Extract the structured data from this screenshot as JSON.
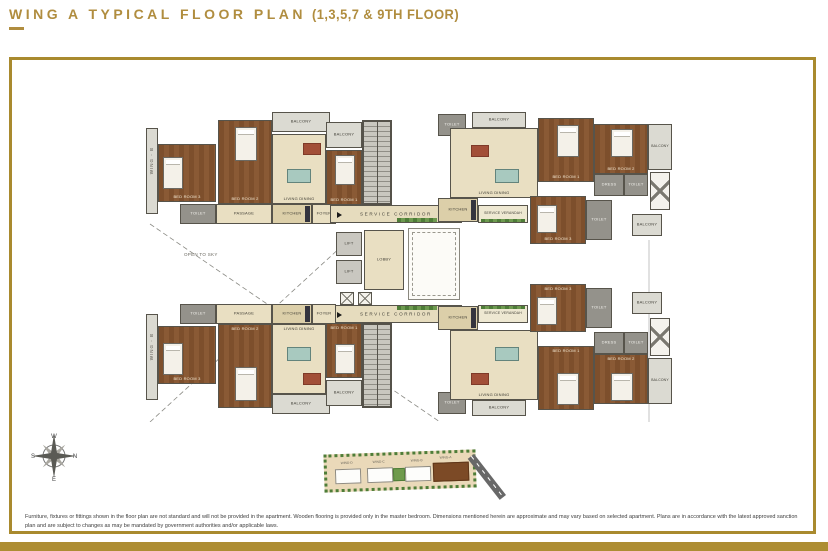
{
  "header": {
    "title": "WING A TYPICAL FLOOR PLAN",
    "floors": "(1,3,5,7 & 9TH FLOOR)"
  },
  "plan": {
    "service_corridor": "SERVICE CORRIDOR",
    "service_verandah": "SERVICE VERANDAH",
    "open_to_sky": "OPEN TO SKY",
    "lobby": "LOBBY",
    "lift": "LIFT",
    "wing_b": "WING - B",
    "rooms": {
      "bedroom1": "BED ROOM 1",
      "bedroom2": "BED ROOM 2",
      "bedroom3": "BED ROOM 3",
      "living_dining": "LIVING DINING",
      "kitchen": "KITCHEN",
      "toilet": "TOILET",
      "balcony": "BALCONY",
      "dress": "DRESS",
      "foyer": "FOYER",
      "passage": "PASSAGE"
    }
  },
  "compass": {
    "n": "N",
    "e": "E",
    "s": "S",
    "w": "W"
  },
  "keyplan": {
    "labels": [
      "WING-D",
      "WING-C",
      "WING-B",
      "WING-A"
    ]
  },
  "footer": {
    "disclaimer": "Furniture, fixtures or fittings shown in the floor plan are not standard and will not be provided in the apartment. Wooden flooring is provided only in the master bedroom. Dimensions mentioned herein are approximate and may vary based on selected apartment. Plans are in accordance with the latest approved sanction plan and are subject to changes as may be mandated by government authorities and/or applicable laws."
  },
  "colors": {
    "gold": "#ad8d33",
    "wood": "#7d4f2c",
    "floor": "#e9dfc2",
    "wall": "#57544b"
  }
}
